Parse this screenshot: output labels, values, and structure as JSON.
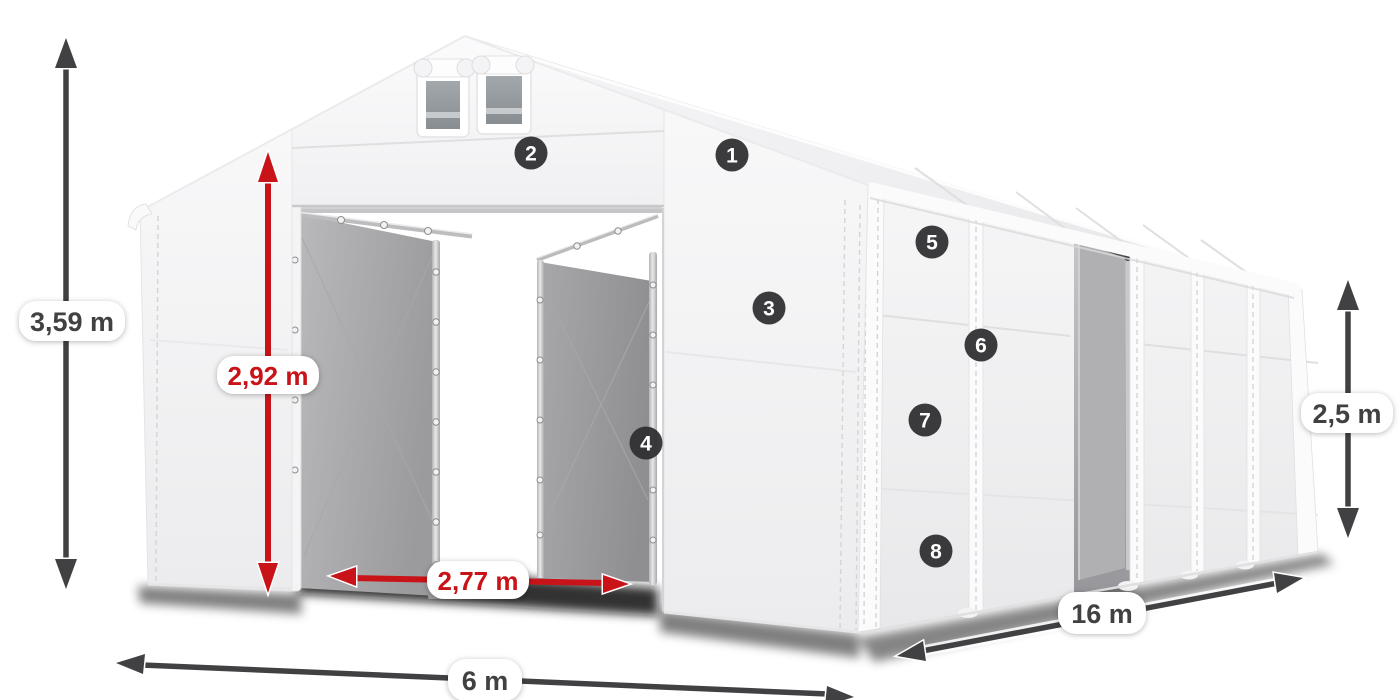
{
  "illustration": {
    "alt": "White storage tent with open gable doors, side door, vents and dimension callouts"
  },
  "dimensions": {
    "total_height": "3,59 m",
    "door_height": "2,92 m",
    "door_width": "2,77 m",
    "front_width": "6 m",
    "side_length": "16 m",
    "side_height": "2,5 m"
  },
  "badges": [
    "1",
    "2",
    "3",
    "4",
    "5",
    "6",
    "7",
    "8"
  ],
  "colors": {
    "dim_dark": "#414143",
    "dim_red": "#c81418",
    "badge_bg": "#2f2f31",
    "badge_text": "#ffffff",
    "pill_bg": "#ffffff",
    "canvas_bg": "#ffffff"
  }
}
